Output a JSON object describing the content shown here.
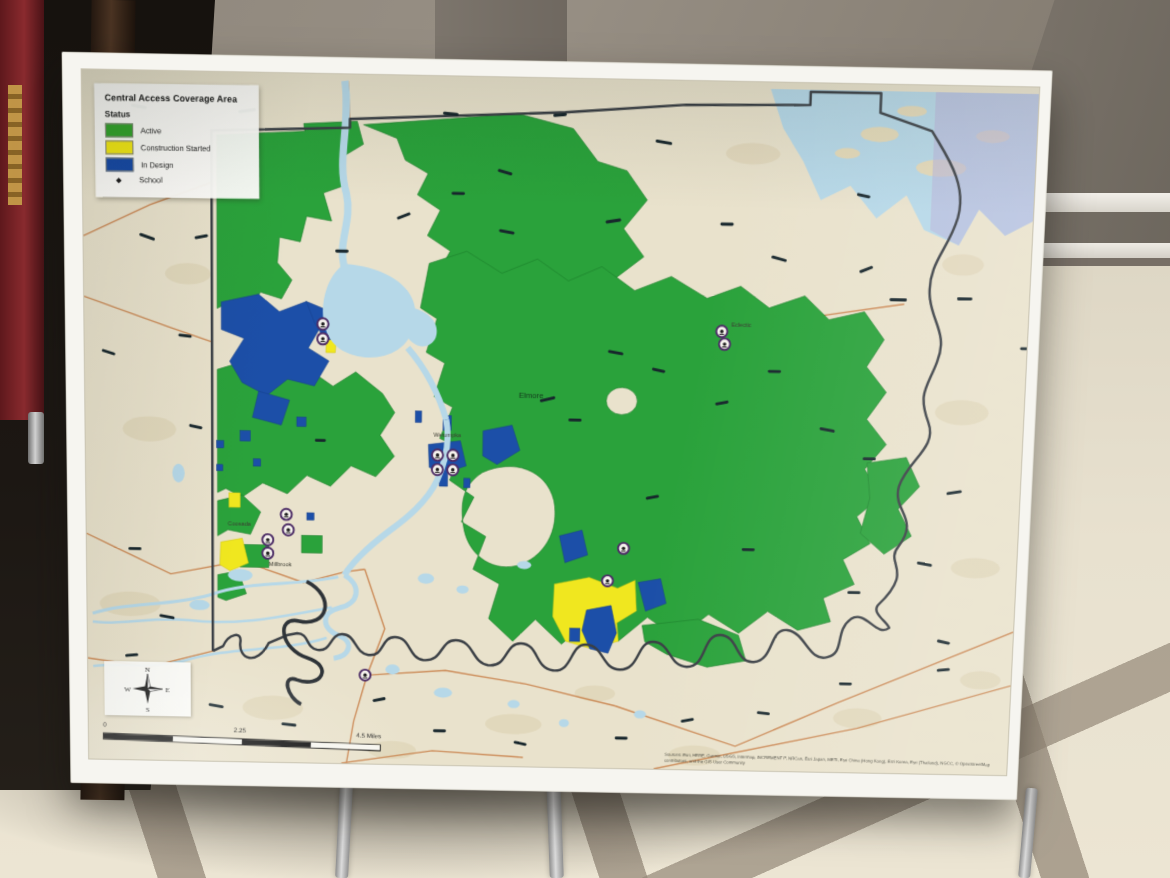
{
  "poster": {
    "legend": {
      "title": "Central Access Coverage Area",
      "status_heading": "Status",
      "items": [
        {
          "label": "Active",
          "color": "#33a52c"
        },
        {
          "label": "Construction Started",
          "color": "#f4ea15"
        },
        {
          "label": "In Design",
          "color": "#1649a6"
        }
      ],
      "school_label": "School",
      "school_glyph": "◆"
    },
    "map": {
      "towns": {
        "elmore": "Elmore",
        "wetumpka": "Wetumpka",
        "coosada": "Coosada",
        "millbrook": "Millbrook",
        "eclectic": "Eclectic"
      },
      "school_marker_count": 15,
      "colors": {
        "active": "#2aa23b",
        "construction_started": "#f0e71f",
        "in_design": "#1c4fa8",
        "water": "#b6d8e8",
        "outside_area_tint": "#b7b5da",
        "school_ring": "#4d2d66",
        "base_terrain": "#e9e2cc"
      }
    },
    "compass": {
      "n": "N",
      "s": "S",
      "e": "E",
      "w": "W"
    },
    "scale_bar": {
      "labels": [
        "0",
        "2.25",
        "4.5 Miles"
      ]
    },
    "attribution": "Sources: Esri, HERE, Garmin, USGS, Intermap, INCREMENT P, NRCan, Esri Japan, METI, Esri China (Hong Kong), Esri Korea, Esri (Thailand), NGCC, © OpenStreetMap contributors, and the GIS User Community"
  }
}
